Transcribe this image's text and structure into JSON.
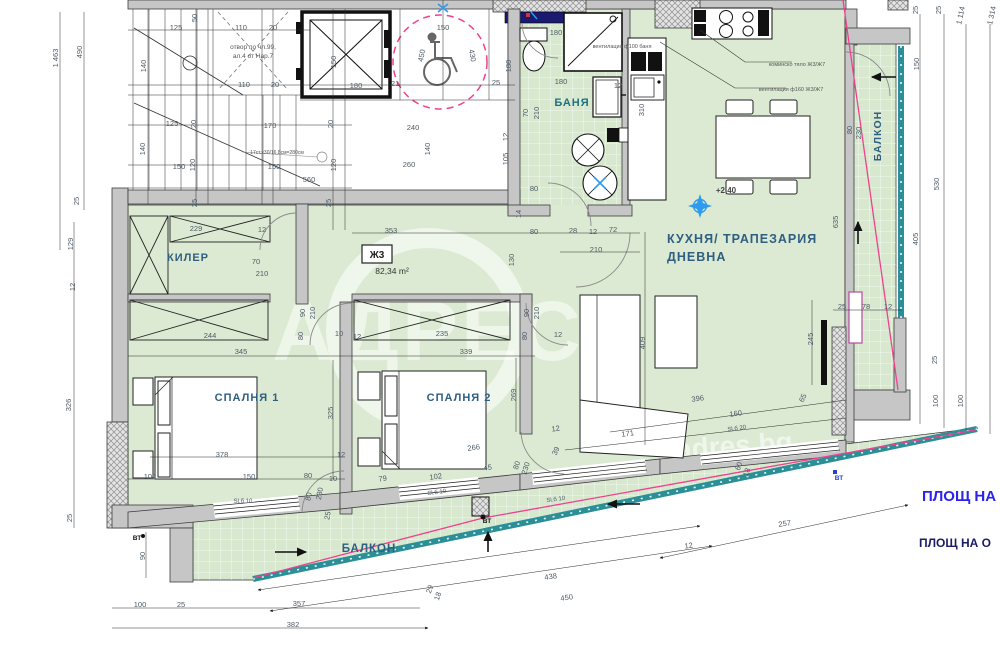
{
  "title": "Ж3 apartment floor plan",
  "colors": {
    "floor_green": "#dcead3",
    "wall_gray": "#c6c6c6",
    "railing_teal": "#2a8f96",
    "pink_line": "#f0418e",
    "entry_navy": "#1a1a70",
    "note_blue": "#2a24ee",
    "note_navy": "#1c1c66",
    "room_label": "#2f5f80",
    "dim_text": "#4d5a66",
    "survey_blue": "#2e9bf0",
    "magenta_frame": "#b84a9e"
  },
  "apartment": {
    "code": "Ж3",
    "area": "82,34 m²",
    "level": "+2,40"
  },
  "room_labels": [
    {
      "t": "КИЛЕР",
      "x": 188,
      "y": 261,
      "s": 11
    },
    {
      "t": "БАНЯ",
      "x": 572,
      "y": 106,
      "s": 11,
      "c": "#1e7080"
    },
    {
      "t": "КУХНЯ/ ТРАПЕЗАРИЯ",
      "x": 667,
      "y": 243,
      "s": 12.5,
      "a": "start"
    },
    {
      "t": "ДНЕВНА",
      "x": 667,
      "y": 261,
      "s": 12.5,
      "a": "start"
    },
    {
      "t": "СПАЛНЯ 1",
      "x": 247,
      "y": 401,
      "s": 11
    },
    {
      "t": "СПАЛНЯ 2",
      "x": 459,
      "y": 401,
      "s": 11
    },
    {
      "t": "БАЛКОН",
      "x": 369,
      "y": 552,
      "s": 11.5
    },
    {
      "t": "БАЛКОН",
      "x": 881,
      "y": 136,
      "s": 10.5,
      "r": -90
    }
  ],
  "annotations": [
    {
      "t": "отвор по чл.99,",
      "x": 253,
      "y": 49,
      "s": 6.5
    },
    {
      "t": "ал.4 от Нар.7",
      "x": 253,
      "y": 58,
      "s": 6.5
    },
    {
      "t": "17ст.х30/16,8см=280см",
      "x": 277,
      "y": 154,
      "s": 5
    },
    {
      "t": "вентилация ф100 баня",
      "x": 622,
      "y": 48,
      "s": 5.5
    },
    {
      "t": "коминско тяло Ж3/Ж7",
      "x": 797,
      "y": 66,
      "s": 5.5
    },
    {
      "t": "вентилация ф160 Ж3/Ж7",
      "x": 791,
      "y": 91,
      "s": 5.5
    },
    {
      "t": "+2,40",
      "x": 726,
      "y": 193,
      "s": 8,
      "w": "bold",
      "c": "#444444"
    },
    {
      "t": "Ж3",
      "x": 377,
      "y": 258,
      "s": 10,
      "w": "bold",
      "c": "#222222"
    },
    {
      "t": "82,34 m²",
      "x": 392,
      "y": 274,
      "s": 8.5,
      "c": "#333333"
    },
    {
      "t": "ВТ",
      "x": 137,
      "y": 540,
      "s": 6.5,
      "c": "#111111",
      "w": "bold"
    },
    {
      "t": "ВТ",
      "x": 487,
      "y": 523,
      "s": 6.5,
      "c": "#111111",
      "w": "bold"
    },
    {
      "t": "ВТ",
      "x": 839,
      "y": 480,
      "s": 6.5,
      "c": "#2543cc",
      "w": "bold"
    }
  ],
  "area_notes": [
    {
      "t": "ПЛОЩ НА",
      "x": 922,
      "y": 501,
      "s": 15,
      "c": "#2a24ee"
    },
    {
      "t": "ПЛОЩ НА О",
      "x": 919,
      "y": 547,
      "s": 12,
      "c": "#1c1c66"
    }
  ],
  "watermark": {
    "brand": "АДРЕС",
    "site": "adres.bg"
  },
  "dimensions": [
    {
      "t": "1 463",
      "x": 58,
      "y": 58,
      "r": -90
    },
    {
      "t": "490",
      "x": 82,
      "y": 52,
      "r": -90
    },
    {
      "t": "25",
      "x": 79,
      "y": 201,
      "r": -90
    },
    {
      "t": "129",
      "x": 73,
      "y": 244,
      "r": -90
    },
    {
      "t": "12",
      "x": 75,
      "y": 287,
      "r": -90
    },
    {
      "t": "326",
      "x": 71,
      "y": 405,
      "r": -90
    },
    {
      "t": "25",
      "x": 72,
      "y": 518,
      "r": -90
    },
    {
      "t": "90",
      "x": 145,
      "y": 556,
      "r": -90
    },
    {
      "t": "125",
      "x": 176,
      "y": 30
    },
    {
      "t": "50",
      "x": 197,
      "y": 18,
      "r": -90
    },
    {
      "t": "110",
      "x": 241,
      "y": 30
    },
    {
      "t": "20",
      "x": 273,
      "y": 30
    },
    {
      "t": "140",
      "x": 146,
      "y": 66,
      "r": -90
    },
    {
      "t": "110",
      "x": 244,
      "y": 87
    },
    {
      "t": "20",
      "x": 275,
      "y": 87
    },
    {
      "t": "150",
      "x": 336,
      "y": 62,
      "r": -90
    },
    {
      "t": "180",
      "x": 356,
      "y": 88
    },
    {
      "t": "150",
      "x": 443,
      "y": 30
    },
    {
      "t": "450",
      "x": 424,
      "y": 56,
      "r": -78
    },
    {
      "t": "430",
      "x": 470,
      "y": 56,
      "r": 78
    },
    {
      "t": "21",
      "x": 395,
      "y": 86
    },
    {
      "t": "25",
      "x": 496,
      "y": 85
    },
    {
      "t": "125",
      "x": 172,
      "y": 126
    },
    {
      "t": "20",
      "x": 196,
      "y": 124,
      "r": -90
    },
    {
      "t": "170",
      "x": 270,
      "y": 128
    },
    {
      "t": "20",
      "x": 333,
      "y": 124,
      "r": -90
    },
    {
      "t": "240",
      "x": 413,
      "y": 130
    },
    {
      "t": "140",
      "x": 145,
      "y": 149,
      "r": -90
    },
    {
      "t": "140",
      "x": 430,
      "y": 149,
      "r": -90
    },
    {
      "t": "150",
      "x": 179,
      "y": 169
    },
    {
      "t": "120",
      "x": 195,
      "y": 165,
      "r": -90
    },
    {
      "t": "150",
      "x": 274,
      "y": 169
    },
    {
      "t": "120",
      "x": 336,
      "y": 165,
      "r": -90
    },
    {
      "t": "260",
      "x": 409,
      "y": 167
    },
    {
      "t": "560",
      "x": 309,
      "y": 182
    },
    {
      "t": "25",
      "x": 197,
      "y": 203,
      "r": -90
    },
    {
      "t": "25",
      "x": 331,
      "y": 203,
      "r": -90
    },
    {
      "t": "180",
      "x": 556,
      "y": 35
    },
    {
      "t": "180",
      "x": 511,
      "y": 66,
      "r": -90
    },
    {
      "t": "180",
      "x": 561,
      "y": 84
    },
    {
      "t": "12",
      "x": 618,
      "y": 88
    },
    {
      "t": "310",
      "x": 644,
      "y": 110,
      "r": -90
    },
    {
      "t": "12",
      "x": 508,
      "y": 137,
      "r": -90
    },
    {
      "t": "105",
      "x": 508,
      "y": 159,
      "r": -90
    },
    {
      "t": "70",
      "x": 528,
      "y": 113,
      "r": -90
    },
    {
      "t": "210",
      "x": 539,
      "y": 113,
      "r": -90
    },
    {
      "t": "80",
      "x": 534,
      "y": 191
    },
    {
      "t": "14",
      "x": 521,
      "y": 214,
      "r": -90
    },
    {
      "t": "353",
      "x": 391,
      "y": 233
    },
    {
      "t": "80",
      "x": 534,
      "y": 234
    },
    {
      "t": "28",
      "x": 573,
      "y": 233
    },
    {
      "t": "12",
      "x": 593,
      "y": 234
    },
    {
      "t": "72",
      "x": 613,
      "y": 232
    },
    {
      "t": "210",
      "x": 596,
      "y": 252
    },
    {
      "t": "130",
      "x": 514,
      "y": 260,
      "r": -90
    },
    {
      "t": "229",
      "x": 196,
      "y": 231
    },
    {
      "t": "12",
      "x": 262,
      "y": 232
    },
    {
      "t": "70",
      "x": 256,
      "y": 264
    },
    {
      "t": "210",
      "x": 262,
      "y": 276
    },
    {
      "t": "90",
      "x": 305,
      "y": 313,
      "r": -90
    },
    {
      "t": "210",
      "x": 315,
      "y": 313,
      "r": -90
    },
    {
      "t": "244",
      "x": 210,
      "y": 338
    },
    {
      "t": "345",
      "x": 241,
      "y": 354
    },
    {
      "t": "80",
      "x": 303,
      "y": 336,
      "r": -90
    },
    {
      "t": "10",
      "x": 339,
      "y": 336
    },
    {
      "t": "12",
      "x": 357,
      "y": 339
    },
    {
      "t": "235",
      "x": 442,
      "y": 336
    },
    {
      "t": "339",
      "x": 466,
      "y": 354
    },
    {
      "t": "90",
      "x": 529,
      "y": 313,
      "r": -90
    },
    {
      "t": "210",
      "x": 539,
      "y": 313,
      "r": -90
    },
    {
      "t": "80",
      "x": 527,
      "y": 336,
      "r": -90
    },
    {
      "t": "12",
      "x": 558,
      "y": 337
    },
    {
      "t": "325",
      "x": 333,
      "y": 413,
      "r": -90
    },
    {
      "t": "269",
      "x": 516,
      "y": 395,
      "r": -90
    },
    {
      "t": "378",
      "x": 222,
      "y": 457
    },
    {
      "t": "12",
      "x": 341,
      "y": 457
    },
    {
      "t": "102",
      "x": 150,
      "y": 479
    },
    {
      "t": "150",
      "x": 249,
      "y": 479
    },
    {
      "t": "80",
      "x": 308,
      "y": 478
    },
    {
      "t": "10",
      "x": 333,
      "y": 481
    },
    {
      "t": "80",
      "x": 311,
      "y": 497,
      "r": -80
    },
    {
      "t": "230",
      "x": 322,
      "y": 494,
      "r": -80
    },
    {
      "t": "25",
      "x": 330,
      "y": 516,
      "r": -80
    },
    {
      "t": "Sl.б 10",
      "x": 243,
      "y": 503,
      "s": 6
    },
    {
      "t": "266",
      "x": 474,
      "y": 450,
      "r": -8
    },
    {
      "t": "45",
      "x": 488,
      "y": 470,
      "r": -8
    },
    {
      "t": "102",
      "x": 436,
      "y": 479,
      "r": -8
    },
    {
      "t": "79",
      "x": 383,
      "y": 481,
      "r": -8
    },
    {
      "t": "80",
      "x": 519,
      "y": 466,
      "r": -72
    },
    {
      "t": "230",
      "x": 528,
      "y": 469,
      "r": -72
    },
    {
      "t": "12",
      "x": 556,
      "y": 431,
      "r": -8
    },
    {
      "t": "39",
      "x": 558,
      "y": 452,
      "r": -65
    },
    {
      "t": "171",
      "x": 628,
      "y": 436,
      "r": -8
    },
    {
      "t": "Sl.б 10",
      "x": 437,
      "y": 494,
      "r": -8,
      "s": 6
    },
    {
      "t": "Sl.б 10",
      "x": 556,
      "y": 501,
      "r": -8,
      "s": 6
    },
    {
      "t": "409",
      "x": 645,
      "y": 343,
      "r": -90
    },
    {
      "t": "396",
      "x": 698,
      "y": 401,
      "r": -8
    },
    {
      "t": "160",
      "x": 736,
      "y": 416,
      "r": -8
    },
    {
      "t": "65",
      "x": 805,
      "y": 399,
      "r": -65
    },
    {
      "t": "245",
      "x": 813,
      "y": 339,
      "r": -90
    },
    {
      "t": "635",
      "x": 838,
      "y": 222,
      "r": -90
    },
    {
      "t": "80",
      "x": 852,
      "y": 130,
      "r": -90
    },
    {
      "t": "230",
      "x": 861,
      "y": 133,
      "r": -90
    },
    {
      "t": "25",
      "x": 842,
      "y": 309
    },
    {
      "t": "78",
      "x": 866,
      "y": 309
    },
    {
      "t": "12",
      "x": 888,
      "y": 309
    },
    {
      "t": "Sl.б 20",
      "x": 737,
      "y": 430,
      "r": -8,
      "s": 6
    },
    {
      "t": "25",
      "x": 918,
      "y": 10,
      "r": -90
    },
    {
      "t": "25",
      "x": 941,
      "y": 10,
      "r": -90
    },
    {
      "t": "1 114",
      "x": 963,
      "y": 16,
      "r": -78
    },
    {
      "t": "1 314",
      "x": 994,
      "y": 16,
      "r": -78
    },
    {
      "t": "150",
      "x": 919,
      "y": 64,
      "r": -90
    },
    {
      "t": "530",
      "x": 939,
      "y": 184,
      "r": -90
    },
    {
      "t": "405",
      "x": 918,
      "y": 239,
      "r": -90
    },
    {
      "t": "25",
      "x": 937,
      "y": 360,
      "r": -90
    },
    {
      "t": "100",
      "x": 938,
      "y": 401,
      "r": -90
    },
    {
      "t": "100",
      "x": 963,
      "y": 401,
      "r": -90
    },
    {
      "t": "100",
      "x": 140,
      "y": 607
    },
    {
      "t": "25",
      "x": 181,
      "y": 607
    },
    {
      "t": "357",
      "x": 299,
      "y": 606
    },
    {
      "t": "382",
      "x": 293,
      "y": 627
    },
    {
      "t": "29",
      "x": 432,
      "y": 590,
      "r": -70
    },
    {
      "t": "18",
      "x": 440,
      "y": 597,
      "r": -70
    },
    {
      "t": "438",
      "x": 551,
      "y": 579,
      "r": -8
    },
    {
      "t": "450",
      "x": 567,
      "y": 600,
      "r": -8
    },
    {
      "t": "12",
      "x": 689,
      "y": 548,
      "r": -8
    },
    {
      "t": "257",
      "x": 785,
      "y": 526,
      "r": -8
    },
    {
      "t": "60",
      "x": 741,
      "y": 467,
      "r": -70
    },
    {
      "t": "18",
      "x": 749,
      "y": 473,
      "r": -70
    }
  ]
}
